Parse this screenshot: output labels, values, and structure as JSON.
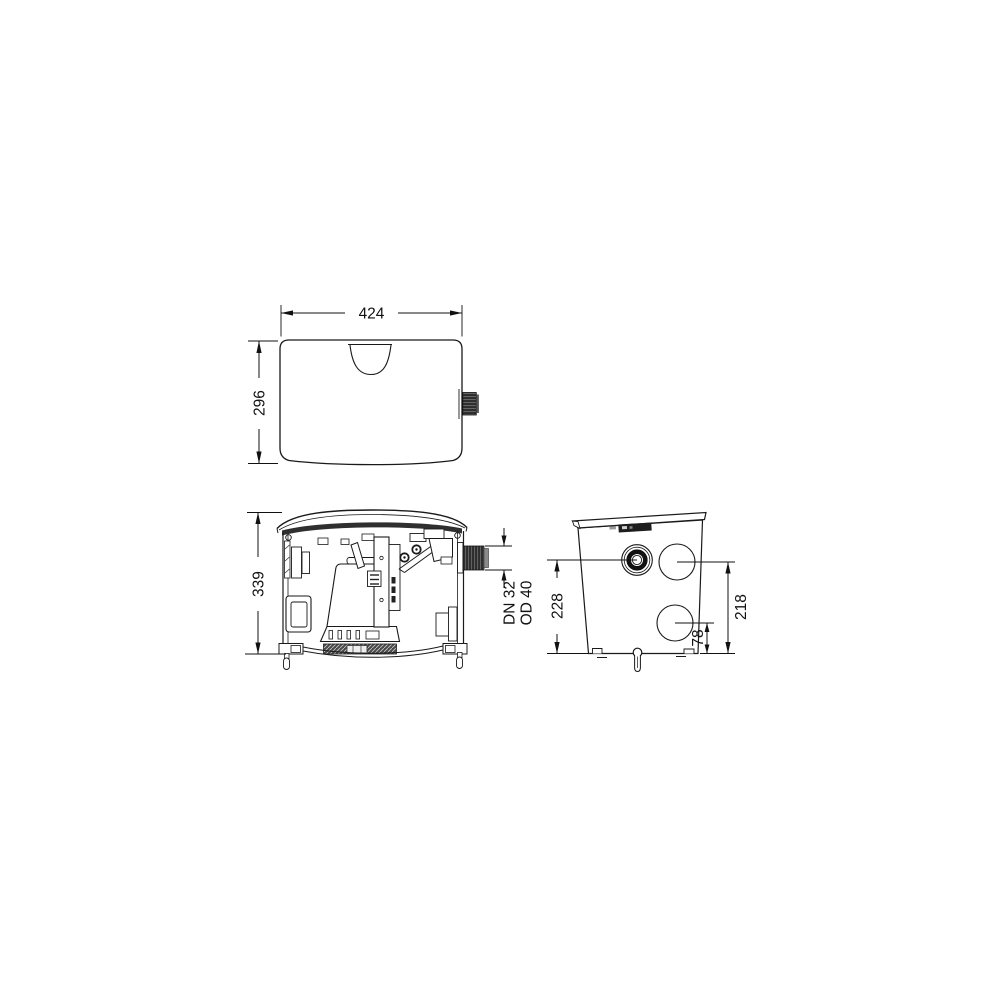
{
  "drawing": {
    "type": "technical-dimension-drawing",
    "background": "#ffffff",
    "line_color": "#1a1a1a",
    "views": {
      "top": {
        "label": "top-view",
        "width_dim": "424",
        "depth_dim": "296"
      },
      "front": {
        "label": "front-view-section",
        "height_dim": "339",
        "outlet": {
          "line1": "DN 32",
          "line2": "OD 40"
        }
      },
      "side": {
        "label": "side-view",
        "inlet_height_dim": "228",
        "knockout_upper_dim": "218",
        "knockout_lower_dim": "78"
      }
    }
  }
}
